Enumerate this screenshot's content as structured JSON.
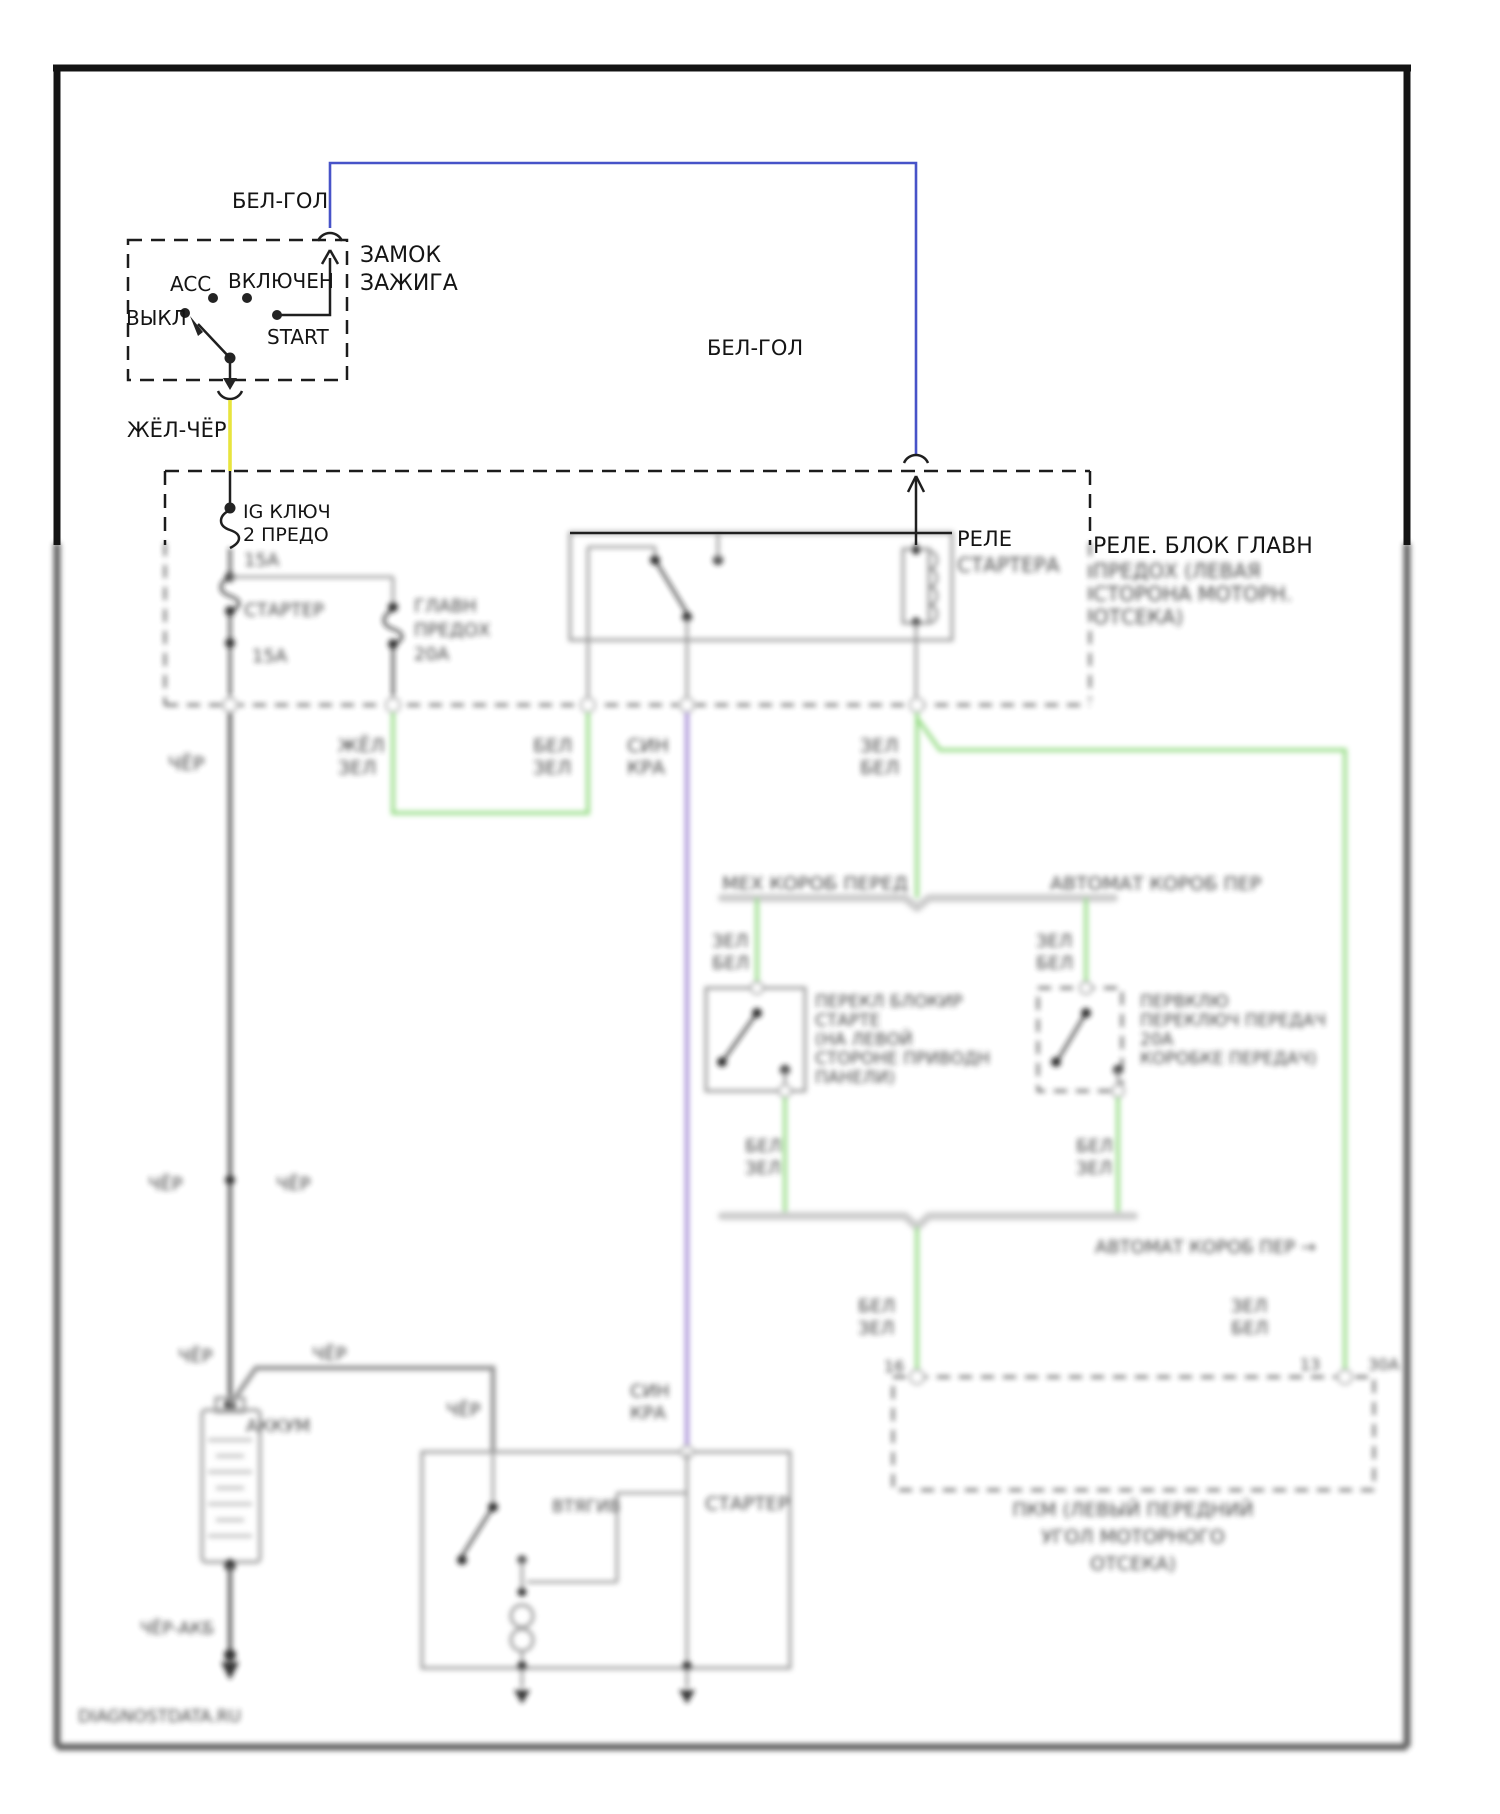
{
  "colors": {
    "wire_blue": "#4753c8",
    "wire_yellow": "#e8e43e",
    "wire_green": "#90da7f",
    "wire_purple": "#9b7fd1",
    "wire_gray": "#8a8a8a",
    "line_black": "#1f1f1f"
  },
  "ignition": {
    "wire_top": "БЕЛ-ГОЛ",
    "wire_bottom": "ЖЁЛ-ЧЁР",
    "title1": "ЗАМОК",
    "title2": "ЗАЖИГА",
    "pos_acc": "ACC",
    "pos_on": "ВКЛЮЧЕН",
    "pos_off": "ВЫКЛ",
    "pos_start": "START"
  },
  "relay": {
    "title": "РЕЛЕ",
    "subtitle": "СТАРТЕРА",
    "wire_in": "БЕЛ-ГОЛ"
  },
  "fusebox": {
    "feed1": "IG КЛЮЧ",
    "feed2": "2 ПРЕДО",
    "fuse1_rating": "15А",
    "fuse2_name": "СТАРТЕР",
    "fuse2_rating": "15А",
    "fuse3_name1": "ГЛАВН",
    "fuse3_name2": "ПРЕДОХ",
    "fuse3_rating": "20А",
    "block_title": "РЕЛЕ. БЛОК ГЛАВН",
    "block_sub1": "ПРЕДОХ (ЛЕВАЯ",
    "block_sub2": "СТОРОНА МОТОРН.",
    "block_sub3": "ОТСЕКА)"
  },
  "wire_labels": {
    "zhel_zel": [
      "ЖЁЛ",
      "ЗЕЛ"
    ],
    "bel_zel_relay": [
      "БЕЛ",
      "ЗЕЛ"
    ],
    "sin_kra": [
      "СИН",
      "КРА"
    ],
    "zel_bel_coil": [
      "ЗЕЛ",
      "БЕЛ"
    ],
    "cher_main": "ЧЁР",
    "cher_splice_l": "ЧЁР",
    "cher_splice_r": "ЧЁР",
    "zel_bel_left": [
      "ЗЕЛ",
      "БЕЛ"
    ],
    "zel_bel_right": [
      "ЗЕЛ",
      "БЕЛ"
    ],
    "bel_zel_left": [
      "БЕЛ",
      "ЗЕЛ"
    ],
    "bel_zel_right": [
      "БЕЛ",
      "ЗЕЛ"
    ],
    "bel_zel_center": [
      "БЕЛ",
      "ЗЕЛ"
    ],
    "zel_bel_pcm": [
      "ЗЕЛ",
      "БЕЛ"
    ],
    "cher_batt1": "ЧЁР",
    "cher_batt2": "ЧЁР",
    "cher_starter": "ЧЁР",
    "sin_kra2": [
      "СИН",
      "КРА"
    ],
    "cher_akb": "ЧЁР-АКБ"
  },
  "transmissions": {
    "manual_header": "МЕХ КОРОБ ПЕРЕД",
    "auto_header": "АВТОМАТ КОРОБ ПЕР",
    "manual_switch": [
      "ПЕРЕКЛ БЛОКИР",
      "СТАРТЕ",
      "(НА ЛЕВОЙ",
      "СТОРОНЕ ПРИВОДН",
      "ПАНЕЛИ)"
    ],
    "auto_switch": [
      "ПЕРВКЛЮ",
      "ПЕРЕКЛЮЧ ПЕРЕДАЧ",
      "20А",
      "КОРОБКЕ ПЕРЕДАЧ)"
    ],
    "auto_ref": "АВТОМАТ КОРОБ ПЕР →"
  },
  "pcm": {
    "pin_left": "16",
    "pin_right": "13",
    "pin_right_rating": "30А",
    "caption": [
      "ПКМ (ЛЕВЫЙ ПЕРЕДНИЙ",
      "УГОЛ МОТОРНОГО",
      "ОТСЕКА)"
    ]
  },
  "battery": {
    "label": "АККУМ"
  },
  "starter": {
    "label": "СТАРТЕР",
    "solenoid": "ВТЯГИВ"
  },
  "watermark": "DIAGNOSTDATA.RU"
}
